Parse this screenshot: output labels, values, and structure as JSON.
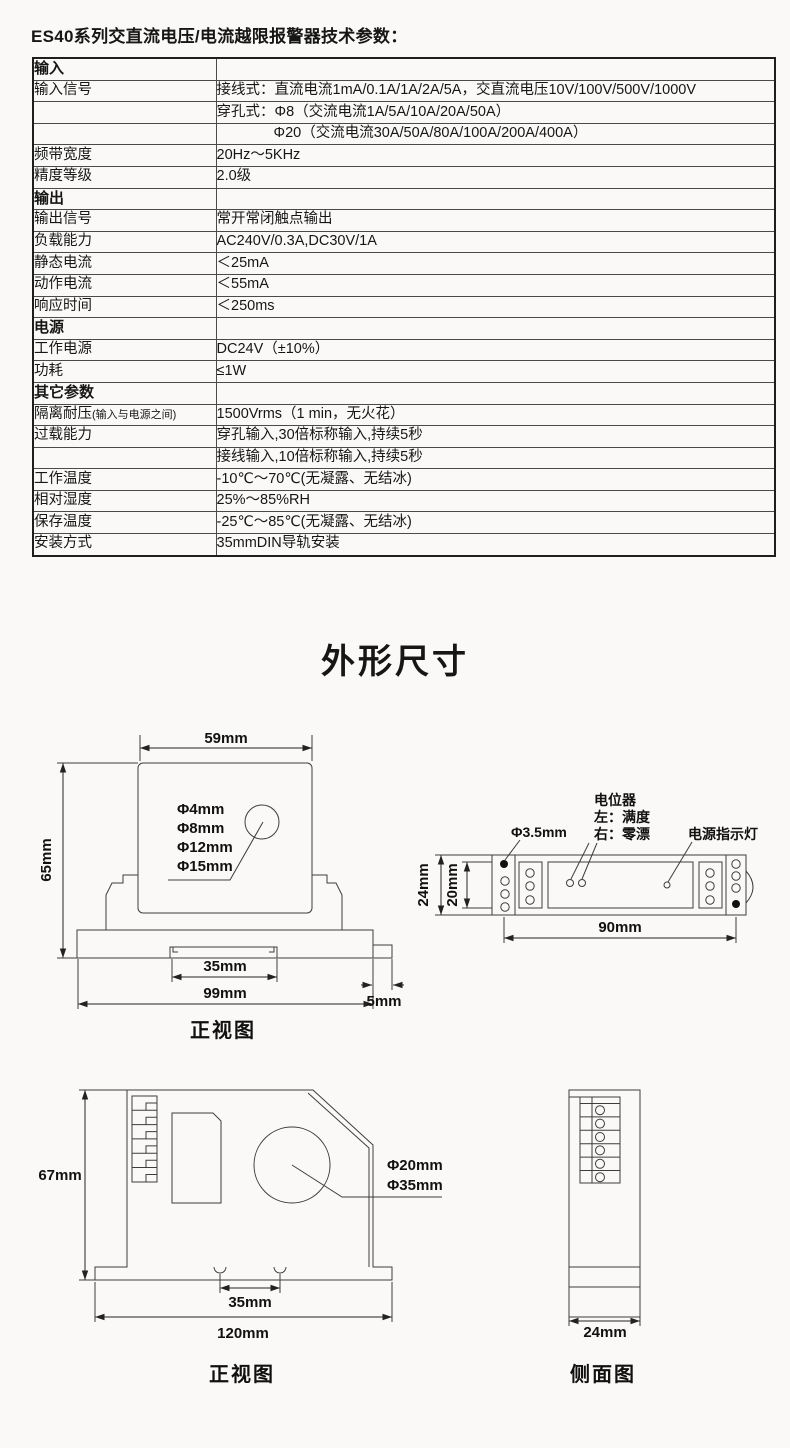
{
  "title": "ES40系列交直流电压/电流越限报警器技术参数：",
  "section_title": "外形尺寸",
  "spec_table": {
    "rows": [
      {
        "label": "输入",
        "value": "",
        "type": "section"
      },
      {
        "label": "输入信号",
        "value": "接线式：直流电流1mA/0.1A/1A/2A/5A，交直流电压10V/100V/500V/1000V"
      },
      {
        "label": "",
        "value": "穿孔式：Φ8（交流电流1A/5A/10A/20A/50A）"
      },
      {
        "label": "",
        "value": "Φ20（交流电流30A/50A/80A/100A/200A/400A）",
        "indent": true
      },
      {
        "label": "频带宽度",
        "value": "20Hz～5KHz"
      },
      {
        "label": "精度等级",
        "value": "2.0级"
      },
      {
        "label": "输出",
        "value": "",
        "type": "section"
      },
      {
        "label": "输出信号",
        "value": "常开常闭触点输出"
      },
      {
        "label": "负载能力",
        "value": "AC240V/0.3A,DC30V/1A"
      },
      {
        "label": "静态电流",
        "value": "＜25mA"
      },
      {
        "label": "动作电流",
        "value": "＜55mA"
      },
      {
        "label": "响应时间",
        "value": "＜250ms"
      },
      {
        "label": "电源",
        "value": "",
        "type": "section"
      },
      {
        "label": "工作电源",
        "value": "DC24V（±10%）"
      },
      {
        "label": "功耗",
        "value": "≤1W"
      },
      {
        "label": "其它参数",
        "value": "",
        "type": "section"
      },
      {
        "label": "隔离耐压",
        "label_small": "(输入与电源之间)",
        "value": "1500Vrms（1 min，无火花）"
      },
      {
        "label": "过载能力",
        "value": "穿孔输入,30倍标称输入,持续5秒"
      },
      {
        "label": "",
        "value": "接线输入,10倍标称输入,持续5秒"
      },
      {
        "label": "工作温度",
        "value": "-10℃～70℃(无凝露、无结冰)"
      },
      {
        "label": "相对湿度",
        "value": "25%～85%RH"
      },
      {
        "label": "保存温度",
        "value": "-25℃～85℃(无凝露、无结冰)"
      },
      {
        "label": "安装方式",
        "value": "35mmDIN导轨安装"
      }
    ]
  },
  "drawings": {
    "front_view_top": {
      "caption": "正视图",
      "dim_width": "59mm",
      "dim_height": "65mm",
      "dim_rail": "35mm",
      "dim_base": "99mm",
      "dim_tab": "5mm",
      "holes": {
        "h4": "Φ4mm",
        "h8": "Φ8mm",
        "h12": "Φ12mm",
        "h15": "Φ15mm"
      }
    },
    "top_view": {
      "pot_title": "电位器",
      "pot_left": "左：满度",
      "pot_right": "右：零漂",
      "hole_label": "Φ3.5mm",
      "led_label": "电源指示灯",
      "dim_height": "24mm",
      "dim_inner": "20mm",
      "dim_width": "90mm"
    },
    "front_view_bottom": {
      "caption": "正视图",
      "dim_height": "67mm",
      "dim_rail": "35mm",
      "dim_width": "120mm",
      "hole20": "Φ20mm",
      "hole35": "Φ35mm"
    },
    "side_view": {
      "caption": "侧面图",
      "dim_width": "24mm"
    }
  }
}
